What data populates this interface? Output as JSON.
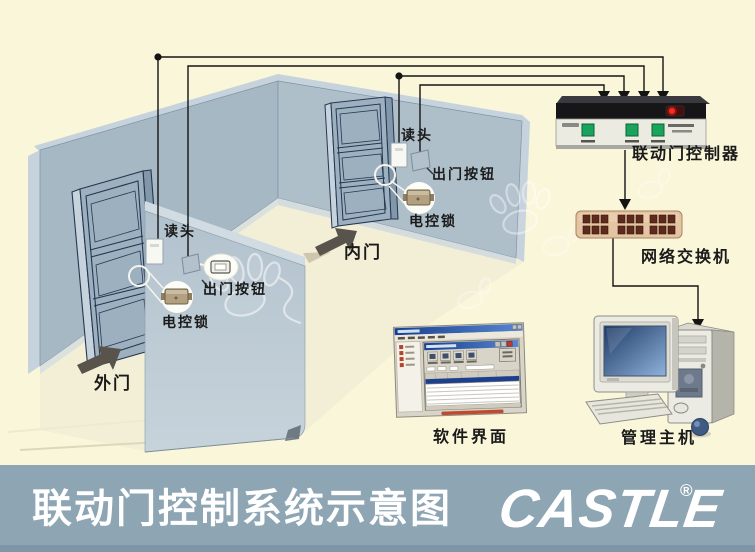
{
  "footer": {
    "title": "联动门控制系统示意图",
    "logo_text": "CASTLE",
    "registered_mark": "®"
  },
  "room": {
    "outer_door": {
      "name": "外门",
      "reader": "读头",
      "exit_button": "出门按钮",
      "lock": "电控锁"
    },
    "inner_door": {
      "name": "内门",
      "reader": "读头",
      "exit_button": "出门按钮",
      "lock": "电控锁"
    }
  },
  "devices": {
    "controller": {
      "label": "联动门控制器"
    },
    "network_switch": {
      "label": "网络交换机"
    },
    "software": {
      "label": "软件界面"
    },
    "host": {
      "label": "管理主机"
    }
  },
  "colors": {
    "background": "#faf6d9",
    "footer_bar": "#8ea5b4",
    "wall": "#a7b8c5",
    "wall_light": "#c6d2dc",
    "door_face": "#9db0c0",
    "wire": "#141414",
    "switch_body": "#e3c5a4",
    "switch_port": "#5e2a1c",
    "controller_button": "#19a35c",
    "controller_indicator": "#ff2a1e",
    "lock_body": "#b3a081",
    "title_text": "#ffffff"
  }
}
